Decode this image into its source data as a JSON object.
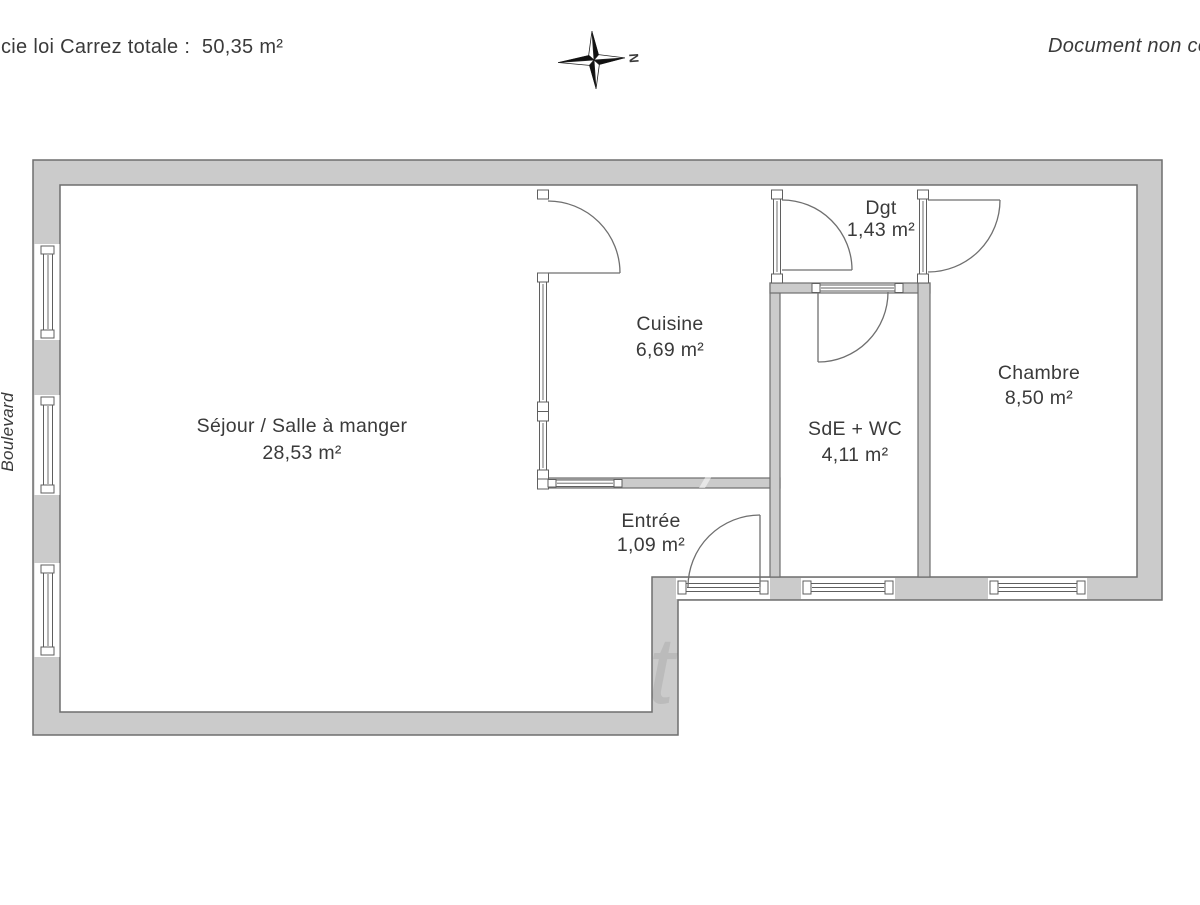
{
  "header": {
    "carrez_label": "cie loi Carrez totale :  50,35 m²",
    "disclaimer": "Document non cor",
    "street_label": "Boulevard",
    "compass_letter": "N"
  },
  "rooms": [
    {
      "name": "Séjour / Salle à manger",
      "area": "28,53 m²"
    },
    {
      "name": "Cuisine",
      "area": "6,69 m²"
    },
    {
      "name": "Dgt",
      "area": "1,43 m²"
    },
    {
      "name": "SdE + WC",
      "area": "4,11 m²"
    },
    {
      "name": "Chambre",
      "area": "8,50 m²"
    },
    {
      "name": "Entrée",
      "area": "1,09 m²"
    }
  ],
  "colors": {
    "wall_fill": "#cbcbcb",
    "wall_outline": "#6e6e6e",
    "text": "#3a3a3a",
    "background": "#ffffff"
  }
}
